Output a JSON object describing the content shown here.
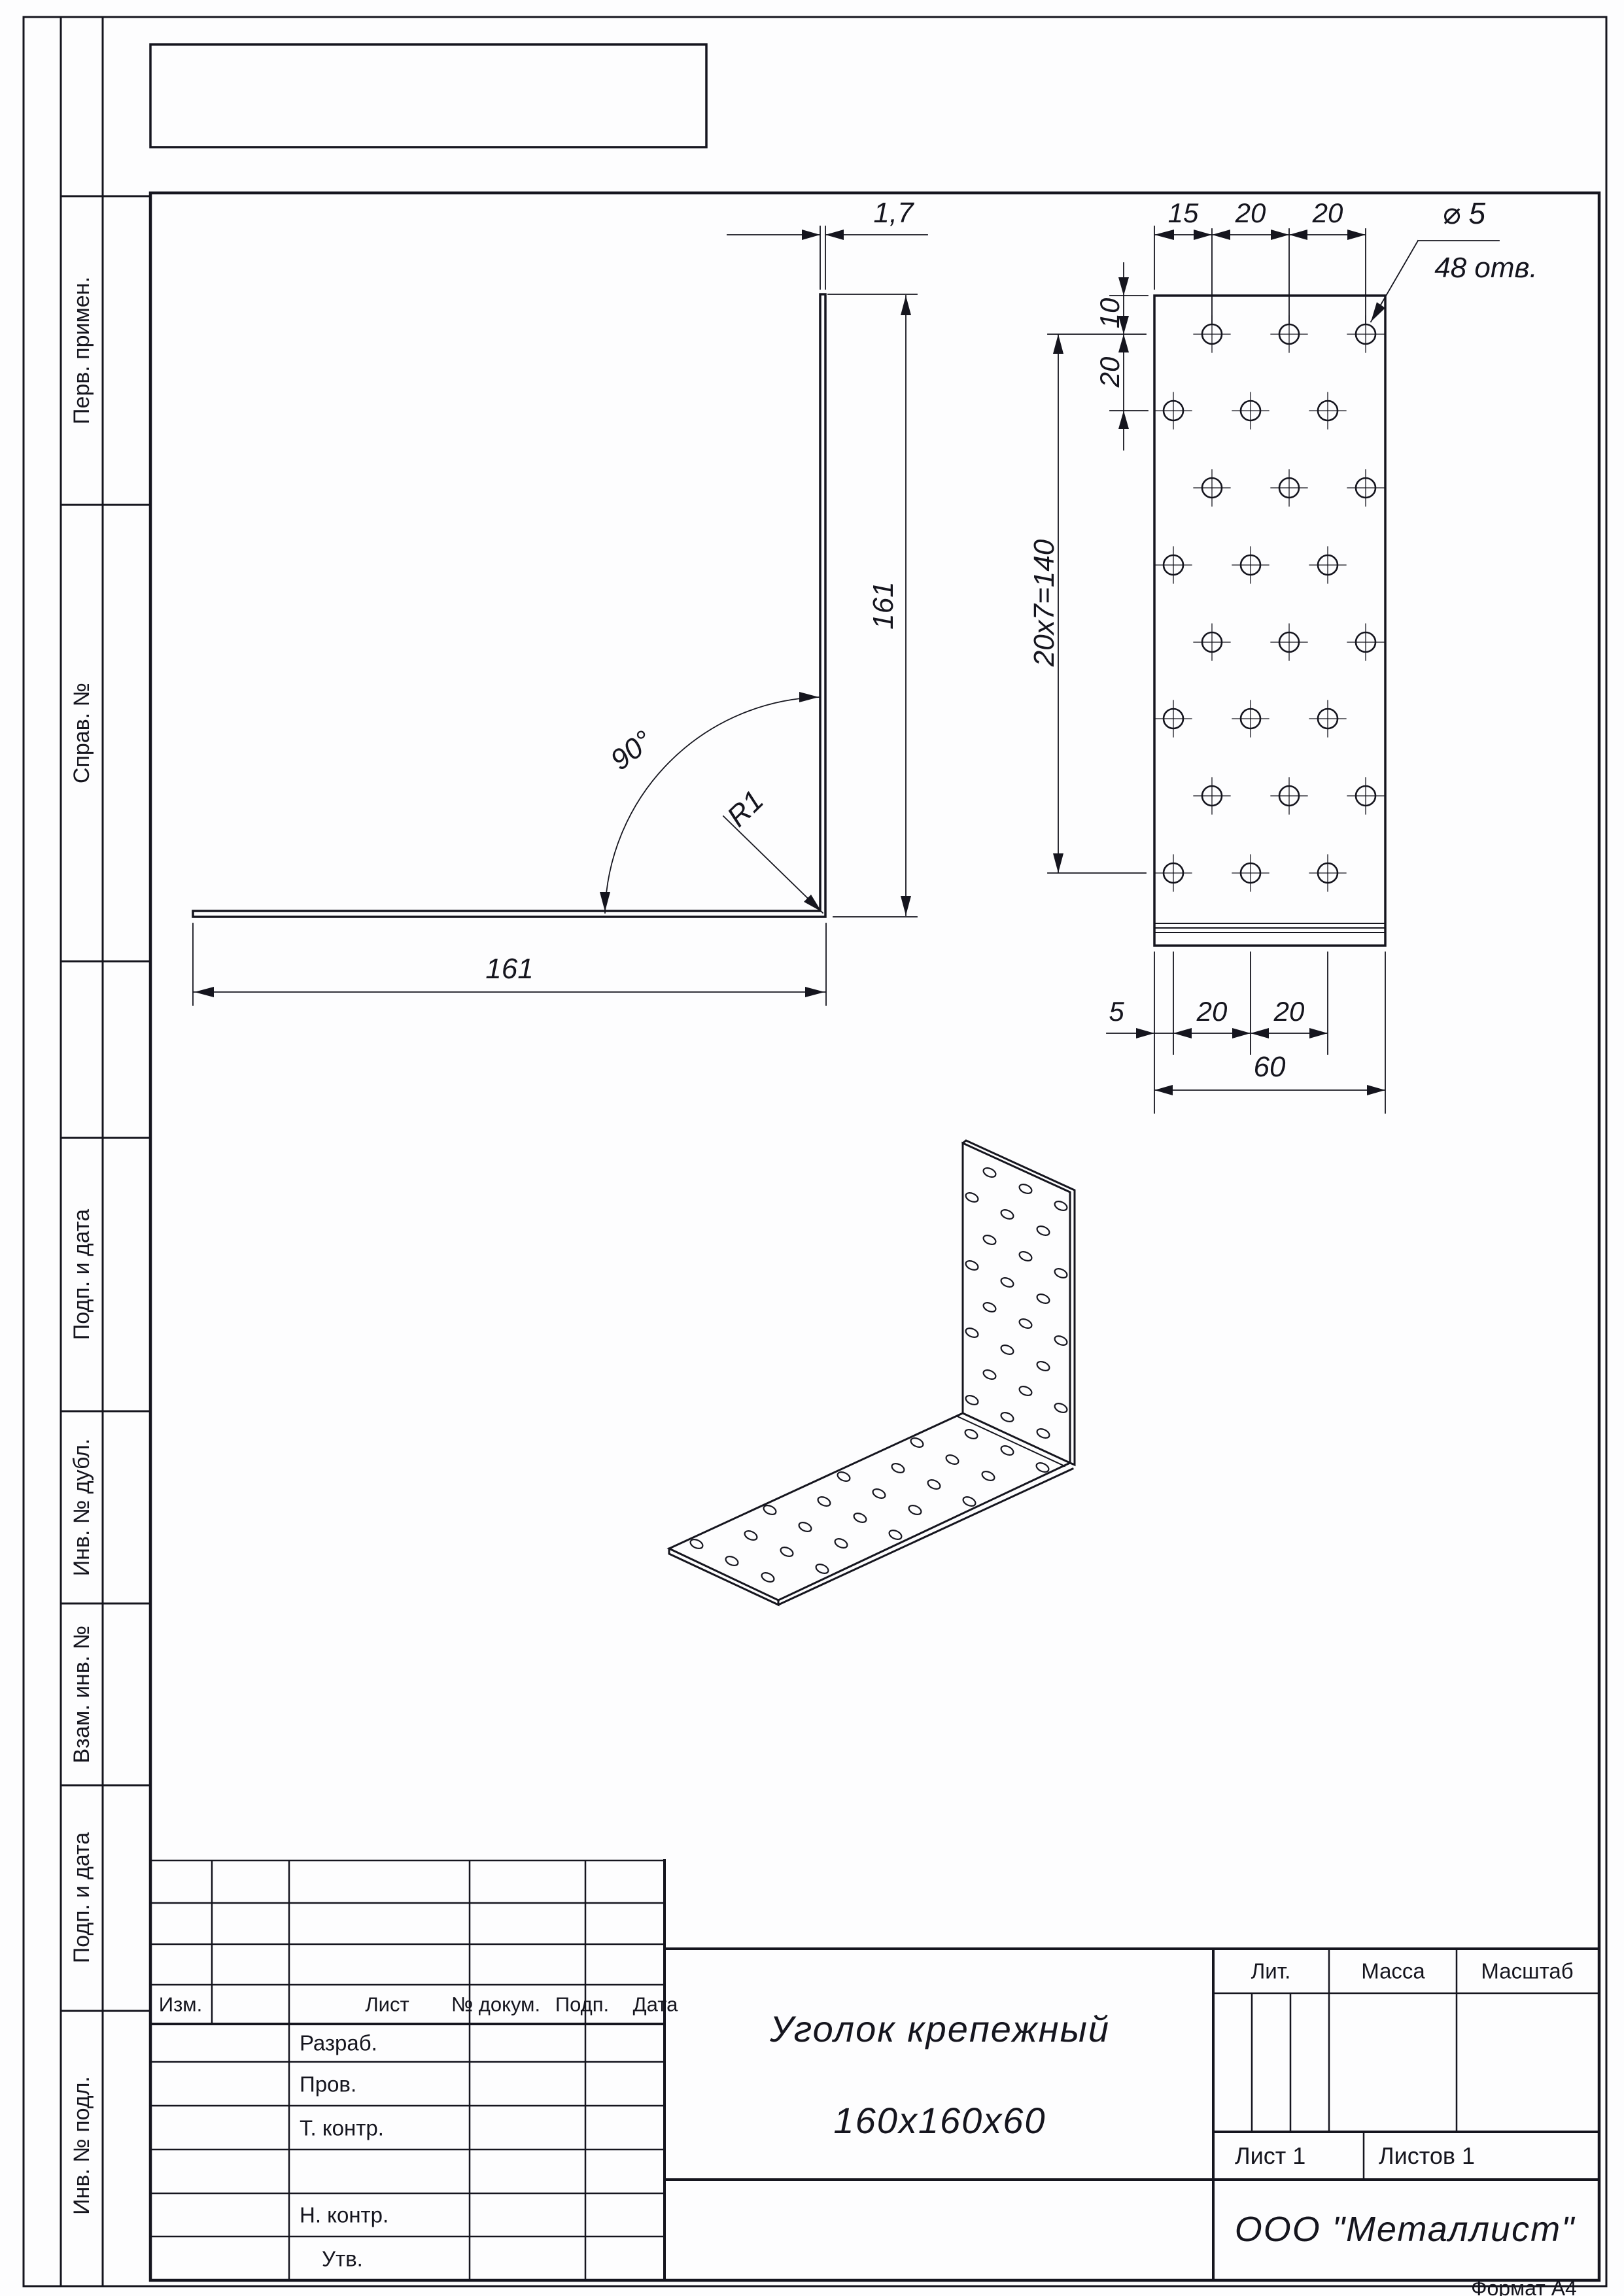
{
  "doc": {
    "format_note": "Формат А4"
  },
  "margin": {
    "labels": [
      "Перв. примен.",
      "Справ. №",
      "Подп. и дата",
      "Инв. № дубл.",
      "Взам. инв. №",
      "Подп. и дата",
      "Инв. № подл."
    ]
  },
  "side_view": {
    "thickness": "1,7",
    "height": "161",
    "length": "161",
    "angle": "90°",
    "radius": "R1"
  },
  "front_view": {
    "offset_top": "15",
    "pitch_top_1": "20",
    "pitch_top_2": "20",
    "hole_dia": "⌀ 5",
    "hole_count": "48 отв.",
    "edge_top": "10",
    "pitch_left": "20",
    "rows_total": "20х7=140",
    "offset_bottom": "5",
    "pitch_bottom_1": "20",
    "pitch_bottom_2": "20",
    "width_total": "60"
  },
  "title_block": {
    "rev_header": {
      "izm": "Изм.",
      "list": "Лист",
      "doc_no": "№ докум.",
      "podp": "Подп.",
      "data": "Дата"
    },
    "roles": {
      "razrab": "Разраб.",
      "prov": "Пров.",
      "tkontr": "Т. контр.",
      "nkontr": "Н. контр.",
      "utv": "Утв."
    },
    "name_line1": "Уголок крепежный",
    "name_line2": "160х160х60",
    "lit": "Лит.",
    "mass": "Масса",
    "scale": "Масштаб",
    "sheet": "Лист 1",
    "sheets": "Листов 1",
    "org": "ООО \"Металлист\""
  }
}
